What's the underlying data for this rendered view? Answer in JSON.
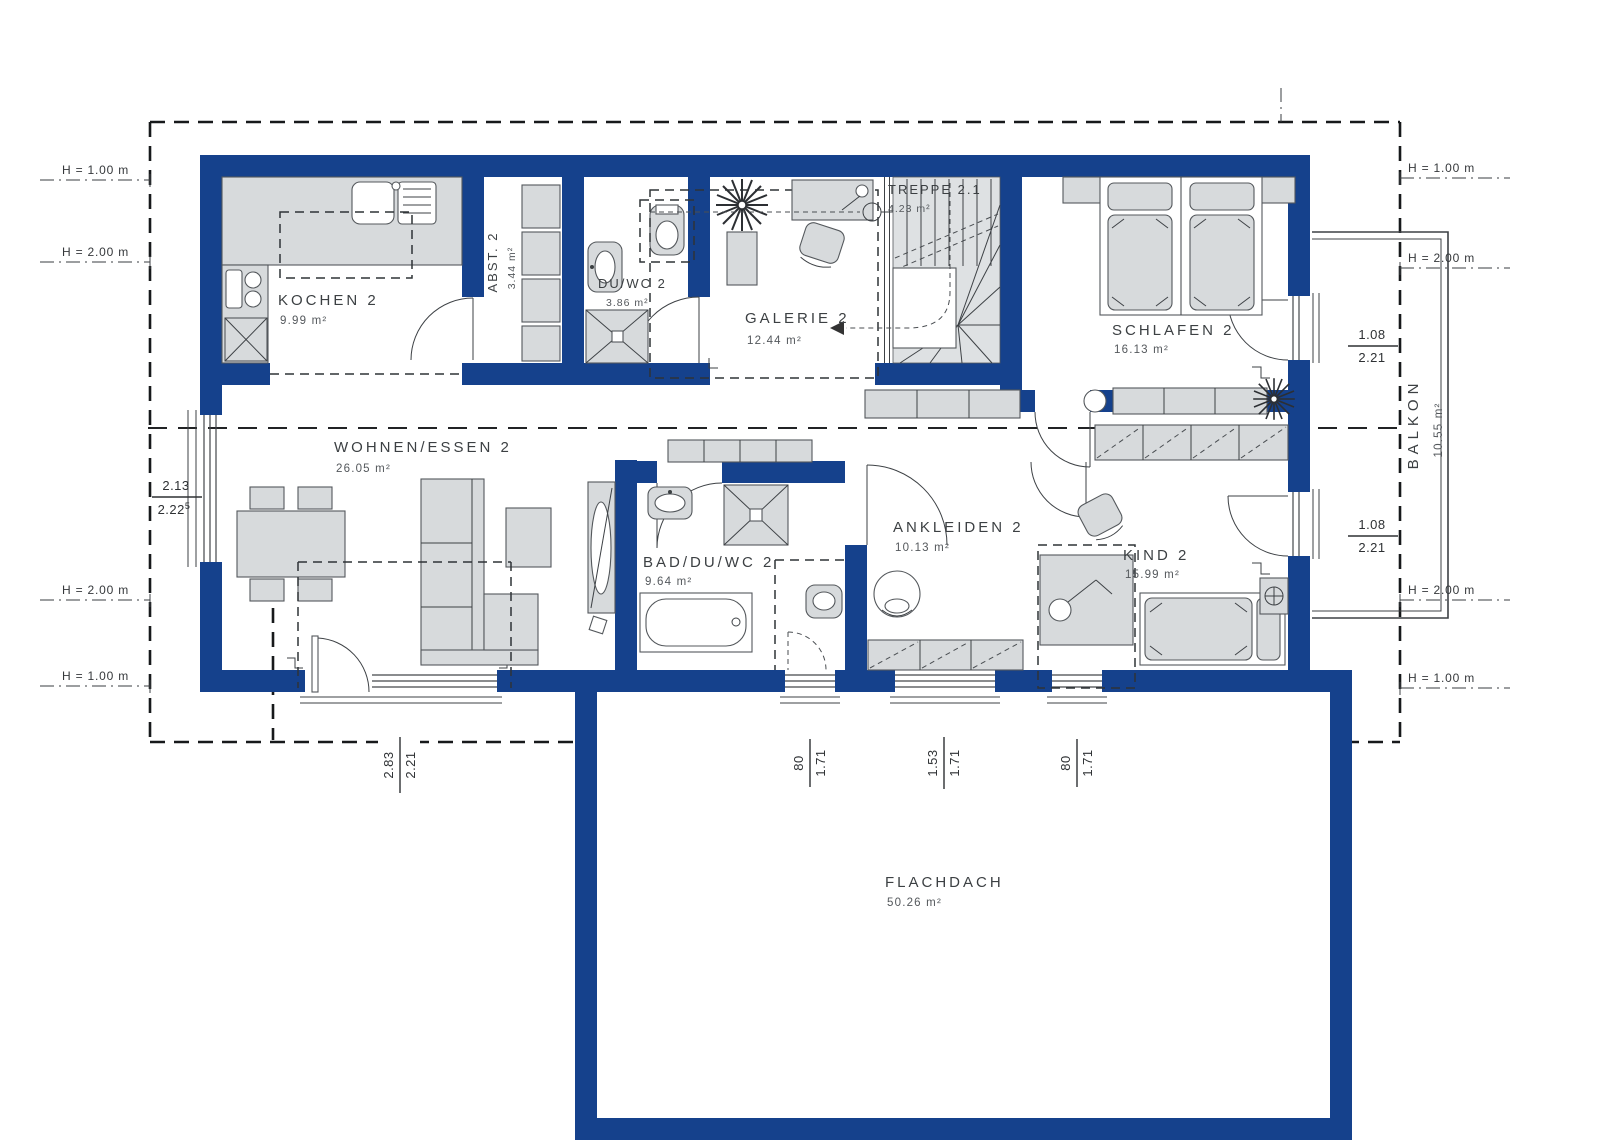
{
  "rooms": {
    "kochen": {
      "name": "KOCHEN 2",
      "area": "9.99 m²"
    },
    "abst": {
      "name": "ABST. 2",
      "area": "3.44 m²"
    },
    "duwc": {
      "name": "DU/WC 2",
      "area": "3.86 m²"
    },
    "galerie": {
      "name": "GALERIE 2",
      "area": "12.44 m²"
    },
    "treppe": {
      "name": "TREPPE 2.1",
      "area": "4.23 m²"
    },
    "schlafen": {
      "name": "SCHLAFEN 2",
      "area": "16.13 m²"
    },
    "wohnen": {
      "name": "WOHNEN/ESSEN 2",
      "area": "26.05 m²"
    },
    "bad": {
      "name": "BAD/DU/WC 2",
      "area": "9.64 m²"
    },
    "ankleiden": {
      "name": "ANKLEIDEN 2",
      "area": "10.13 m²"
    },
    "kind": {
      "name": "KIND 2",
      "area": "15.99 m²"
    },
    "balkon": {
      "name": "BALKON",
      "area": "10.55 m²"
    },
    "flachdach": {
      "name": "FLACHDACH",
      "area": "50.26 m²"
    }
  },
  "height_markers": {
    "h100": "H = 1.00 m",
    "h200": "H = 2.00 m"
  },
  "dims": {
    "left_window": {
      "num": "2.13",
      "den": "2.22",
      "den_sup": "5"
    },
    "schlafen_balcony_door": {
      "num": "1.08",
      "den": "2.21"
    },
    "kind_balcony_door": {
      "num": "1.08",
      "den": "2.21"
    },
    "terrace": {
      "num": "2.83",
      "den": "2.21"
    },
    "bad_window": {
      "num": "80",
      "den": "1.71"
    },
    "ankleiden_window": {
      "num": "1.53",
      "den": "1.71"
    },
    "kind_window": {
      "num": "80",
      "den": "1.71"
    }
  },
  "colors": {
    "wall_blue": "#15418c",
    "furniture_gray": "#d7dadc"
  }
}
